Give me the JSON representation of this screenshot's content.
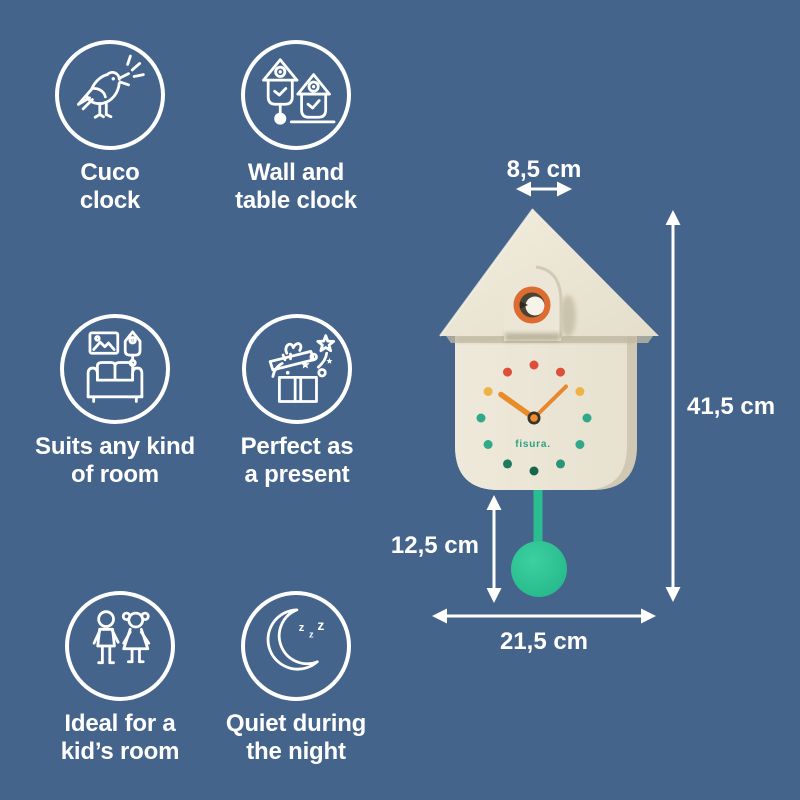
{
  "features": [
    {
      "name": "cuco-clock",
      "line1": "Cuco",
      "line2": "clock"
    },
    {
      "name": "wall-and-table-clock",
      "line1": "Wall and",
      "line2": "table clock"
    },
    {
      "name": "suits-any-room",
      "line1": "Suits any kind",
      "line2": "of room"
    },
    {
      "name": "perfect-present",
      "line1": "Perfect as",
      "line2": "a present"
    },
    {
      "name": "kids-room",
      "line1": "Ideal for a",
      "line2": "kid’s room"
    },
    {
      "name": "quiet-night",
      "line1": "Quiet during",
      "line2": "the night",
      "zzz": [
        "z",
        "z",
        "z"
      ]
    }
  ],
  "product": {
    "brand": "fisura.",
    "type": "cuckoo wall clock",
    "colors": {
      "background": "#44648c",
      "body_cream": "#ece7d8",
      "body_side": "#d0c8b2",
      "ring_orange": "#dc6c30",
      "hands_orange": "#e8872b",
      "pendulum_green": "#2bc795",
      "dot_red": "#dd4f3c",
      "dot_yellow": "#eeb245",
      "dot_teal": "#2fa98a",
      "dot_dark_green": "#17654c"
    }
  },
  "dimensions": {
    "top_depth": "8,5 cm",
    "total_height": "41,5 cm",
    "pendulum_length": "12,5 cm",
    "total_width": "21,5 cm"
  }
}
